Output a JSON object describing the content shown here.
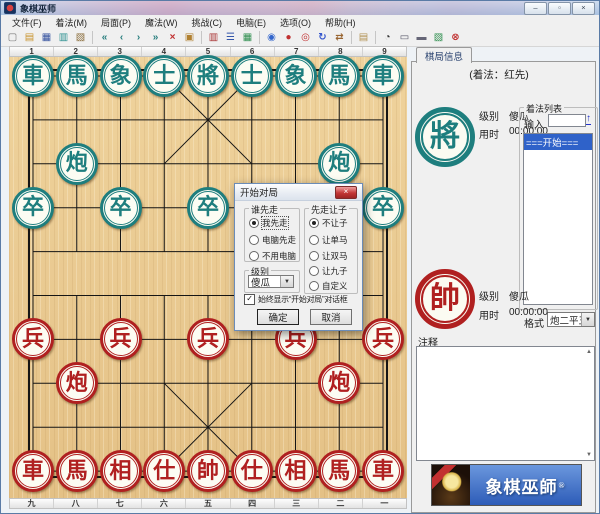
{
  "window": {
    "title": "象棋巫师",
    "controls": {
      "minimize": "–",
      "maximize": "▫",
      "close": "×"
    }
  },
  "menu": {
    "items": [
      "文件(F)",
      "着法(M)",
      "局面(P)",
      "魔法(W)",
      "挑战(C)",
      "电脑(E)",
      "选项(O)",
      "帮助(H)"
    ]
  },
  "toolbar": {
    "items": [
      {
        "name": "new-file-icon",
        "glyph": "▢",
        "color": "#777777"
      },
      {
        "name": "open-file-icon",
        "glyph": "▤",
        "color": "#c8922a"
      },
      {
        "name": "save-icon",
        "glyph": "▦",
        "color": "#33519e"
      },
      {
        "name": "copy-position-icon",
        "glyph": "▥",
        "color": "#2a8f8f"
      },
      {
        "name": "export-icon",
        "glyph": "▧",
        "color": "#8a6d3b"
      },
      {
        "sep": true
      },
      {
        "name": "first-move-icon",
        "glyph": "«",
        "color": "#2a7f7f"
      },
      {
        "name": "prev-move-icon",
        "glyph": "‹",
        "color": "#2a7f7f"
      },
      {
        "name": "next-move-icon",
        "glyph": "›",
        "color": "#2a7f7f"
      },
      {
        "name": "last-move-icon",
        "glyph": "»",
        "color": "#2a7f7f"
      },
      {
        "name": "delete-move-icon",
        "glyph": "×",
        "color": "#c03030"
      },
      {
        "name": "paste-icon",
        "glyph": "▣",
        "color": "#b08030"
      },
      {
        "sep": true
      },
      {
        "name": "opening-book-icon",
        "glyph": "▥",
        "color": "#a83232"
      },
      {
        "name": "move-list-icon",
        "glyph": "☰",
        "color": "#3355aa"
      },
      {
        "name": "board-setup-icon",
        "glyph": "▦",
        "color": "#2f8f4f"
      },
      {
        "sep": true
      },
      {
        "name": "web-icon",
        "glyph": "◉",
        "color": "#3366cc"
      },
      {
        "name": "piece-style-icon",
        "glyph": "●",
        "color": "#c03030"
      },
      {
        "name": "review-icon",
        "glyph": "◎",
        "color": "#c03030"
      },
      {
        "name": "rotate-board-icon",
        "glyph": "↻",
        "color": "#3355cc"
      },
      {
        "name": "flip-board-icon",
        "glyph": "⇄",
        "color": "#996633"
      },
      {
        "sep": true
      },
      {
        "name": "manual-icon",
        "glyph": "▤",
        "color": "#b09050"
      },
      {
        "sep": true
      },
      {
        "name": "timer-icon",
        "glyph": "◔",
        "color": "#333333"
      },
      {
        "name": "computer-icon",
        "glyph": "▭",
        "color": "#555566"
      },
      {
        "name": "printer-icon",
        "glyph": "▬",
        "color": "#667"
      },
      {
        "name": "chart-icon",
        "glyph": "▧",
        "color": "#2f8f4f"
      },
      {
        "name": "stop-icon",
        "glyph": "⊗",
        "color": "#c03030"
      }
    ]
  },
  "board": {
    "top_labels": [
      "1",
      "2",
      "3",
      "4",
      "5",
      "6",
      "7",
      "8",
      "9"
    ],
    "bottom_labels": [
      "九",
      "八",
      "七",
      "六",
      "五",
      "四",
      "三",
      "二",
      "一"
    ],
    "pieces": [
      {
        "c": "車",
        "side": "black",
        "col": 1,
        "row": 1
      },
      {
        "c": "馬",
        "side": "black",
        "col": 2,
        "row": 1
      },
      {
        "c": "象",
        "side": "black",
        "col": 3,
        "row": 1
      },
      {
        "c": "士",
        "side": "black",
        "col": 4,
        "row": 1
      },
      {
        "c": "將",
        "side": "black",
        "col": 5,
        "row": 1
      },
      {
        "c": "士",
        "side": "black",
        "col": 6,
        "row": 1
      },
      {
        "c": "象",
        "side": "black",
        "col": 7,
        "row": 1
      },
      {
        "c": "馬",
        "side": "black",
        "col": 8,
        "row": 1
      },
      {
        "c": "車",
        "side": "black",
        "col": 9,
        "row": 1
      },
      {
        "c": "炮",
        "side": "black",
        "col": 2,
        "row": 3
      },
      {
        "c": "炮",
        "side": "black",
        "col": 8,
        "row": 3
      },
      {
        "c": "卒",
        "side": "black",
        "col": 1,
        "row": 4
      },
      {
        "c": "卒",
        "side": "black",
        "col": 3,
        "row": 4
      },
      {
        "c": "卒",
        "side": "black",
        "col": 5,
        "row": 4
      },
      {
        "c": "卒",
        "side": "black",
        "col": 7,
        "row": 4
      },
      {
        "c": "卒",
        "side": "black",
        "col": 9,
        "row": 4
      },
      {
        "c": "兵",
        "side": "red",
        "col": 1,
        "row": 7
      },
      {
        "c": "兵",
        "side": "red",
        "col": 3,
        "row": 7
      },
      {
        "c": "兵",
        "side": "red",
        "col": 5,
        "row": 7
      },
      {
        "c": "兵",
        "side": "red",
        "col": 7,
        "row": 7
      },
      {
        "c": "兵",
        "side": "red",
        "col": 9,
        "row": 7
      },
      {
        "c": "炮",
        "side": "red",
        "col": 2,
        "row": 8
      },
      {
        "c": "炮",
        "side": "red",
        "col": 8,
        "row": 8
      },
      {
        "c": "車",
        "side": "red",
        "col": 1,
        "row": 10
      },
      {
        "c": "馬",
        "side": "red",
        "col": 2,
        "row": 10
      },
      {
        "c": "相",
        "side": "red",
        "col": 3,
        "row": 10
      },
      {
        "c": "仕",
        "side": "red",
        "col": 4,
        "row": 10
      },
      {
        "c": "帥",
        "side": "red",
        "col": 5,
        "row": 10
      },
      {
        "c": "仕",
        "side": "red",
        "col": 6,
        "row": 10
      },
      {
        "c": "相",
        "side": "red",
        "col": 7,
        "row": 10
      },
      {
        "c": "馬",
        "side": "red",
        "col": 8,
        "row": 10
      },
      {
        "c": "車",
        "side": "red",
        "col": 9,
        "row": 10
      }
    ]
  },
  "panel": {
    "tab": "棋局信息",
    "heading": "(着法：红先)",
    "black": {
      "piece": "將",
      "level_label": "级别",
      "level": "傻瓜",
      "time_label": "用时",
      "time": "00:00:00"
    },
    "red": {
      "piece": "帥",
      "level_label": "级别",
      "level": "傻瓜",
      "time_label": "用时",
      "time": "00:00:00"
    },
    "move_list": {
      "group_label": "着法列表",
      "input_label": "输入",
      "input_value": "",
      "go_glyph": "↑",
      "items": [
        "===开始==="
      ],
      "selected_index": 0
    },
    "format": {
      "label": "格式",
      "value": "炮二平五"
    },
    "comment_label": "注释",
    "banner": {
      "text": "象棋巫師",
      "reg": "®"
    }
  },
  "dialog": {
    "title": "开始对局",
    "close_glyph": "×",
    "who_first": {
      "label": "谁先走",
      "options": [
        {
          "label": "我先走",
          "selected": true
        },
        {
          "label": "电脑先走",
          "selected": false
        },
        {
          "label": "不用电脑",
          "selected": false
        }
      ]
    },
    "handicap": {
      "label": "先走让子",
      "options": [
        {
          "label": "不让子",
          "selected": true
        },
        {
          "label": "让单马",
          "selected": false
        },
        {
          "label": "让双马",
          "selected": false
        },
        {
          "label": "让九子",
          "selected": false
        },
        {
          "label": "自定义",
          "selected": false
        }
      ]
    },
    "level": {
      "label": "级别",
      "value": "傻瓜"
    },
    "checkbox": {
      "label": "始终显示“开始对局”对话框",
      "checked": true,
      "check_glyph": "✓"
    },
    "ok": "确定",
    "cancel": "取消"
  },
  "colors": {
    "black_piece": "#1e7e7e",
    "red_piece": "#b02020",
    "board_wood": "#eacb93",
    "selection_blue": "#2f62c9",
    "banner_blue": "#3a6fc9"
  }
}
